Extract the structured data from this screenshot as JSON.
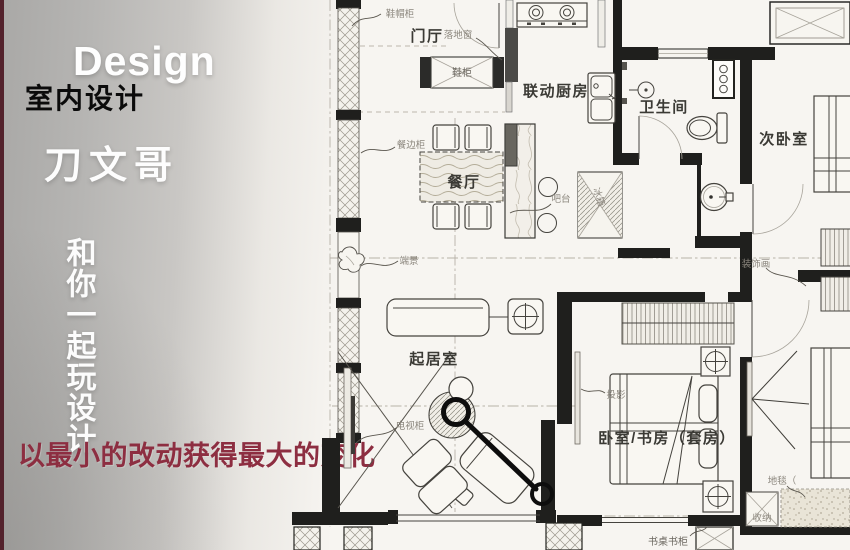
{
  "panel": {
    "title_en": "Design",
    "subtitle_cn": "室内设计",
    "author_name": "刀文哥",
    "slogan_vertical": "和你一起玩设计",
    "tagline": "以最小的改动获得最大的变化",
    "colors": {
      "tagline_red": "#8d2e41",
      "edge_strip_maroon": "#53222c",
      "panel_gray": "#b3b2b0",
      "plan_paper": "#f7f5f1"
    }
  },
  "floorplan": {
    "room_labels": {
      "foyer": "门厅",
      "kitchen": "联动厨房",
      "bathroom": "卫生间",
      "secondary_bedroom": "次卧室",
      "dining": "餐厅",
      "living": "起居室",
      "suite": "卧室/书房（套房）"
    },
    "item_labels": {
      "shoe_hat_cabinet": "鞋帽柜",
      "floor_window": "落地窗",
      "shoe_cabinet": "鞋柜",
      "sideboard": "餐边柜",
      "bar_counter": "吧台",
      "fridge": "冰箱",
      "endscape": "端景",
      "tv_cabinet": "电视柜",
      "projection": "投影",
      "decor_painting": "装饰画",
      "carpet": "地毯（",
      "storage": "收纳",
      "desk_bookcase": "书桌书柜"
    }
  }
}
